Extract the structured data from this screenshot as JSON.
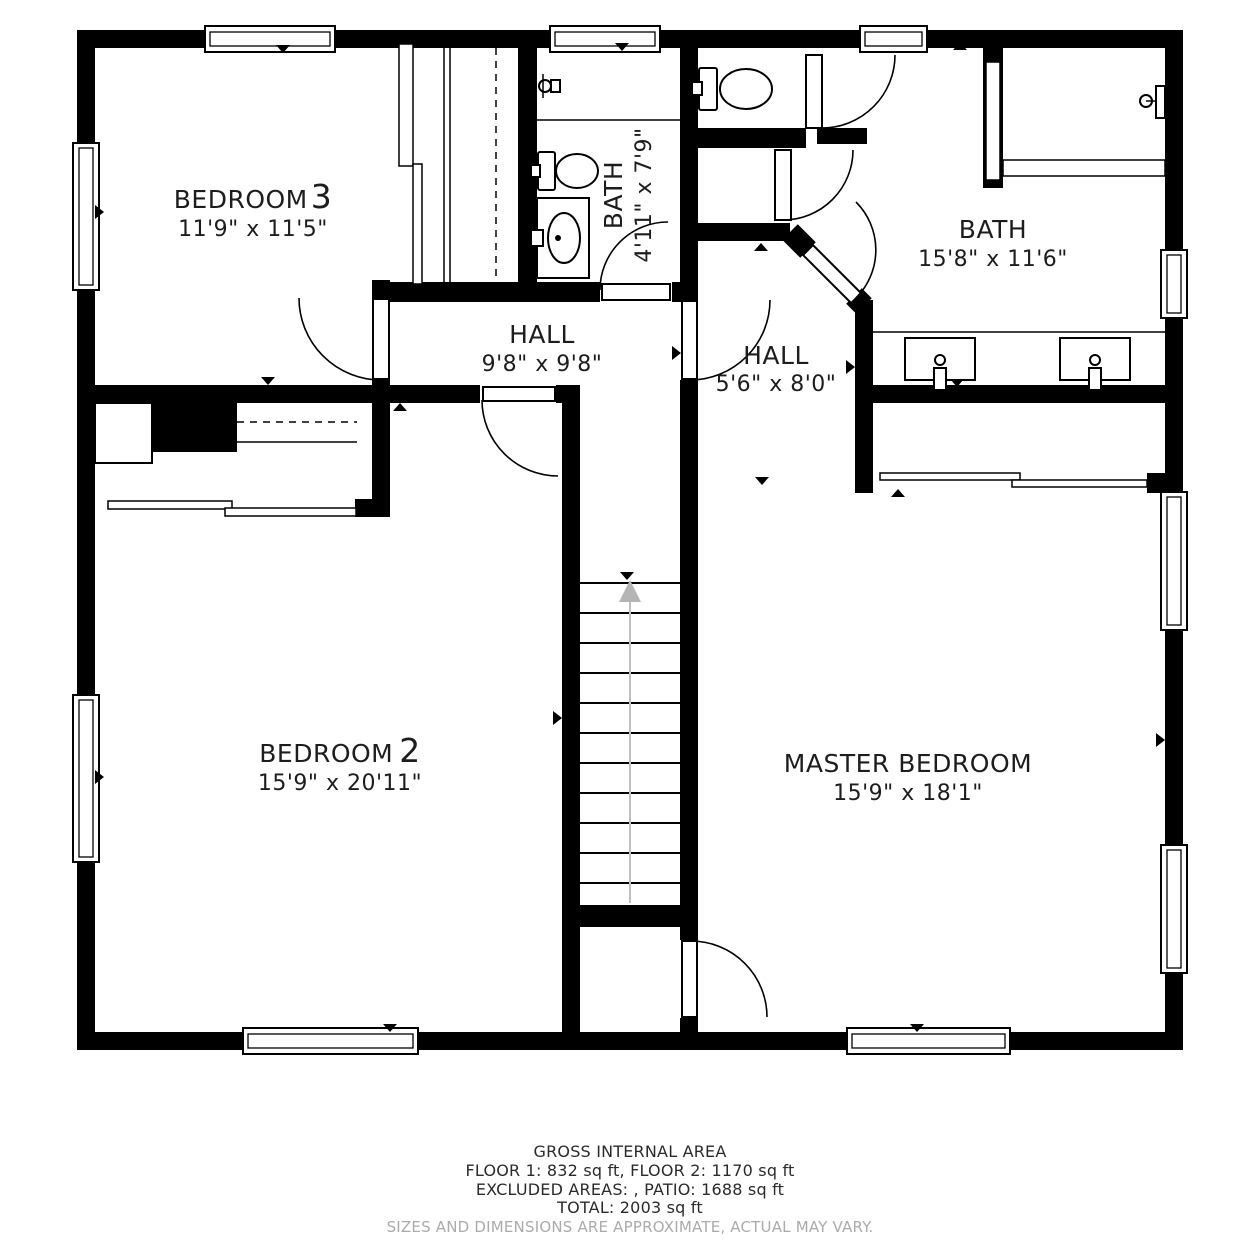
{
  "floor_plan": {
    "rooms": [
      {
        "id": "bedroom-3",
        "name": "BEDROOM",
        "number": "3",
        "dimensions": "11'9\" x 11'5\""
      },
      {
        "id": "bath-small",
        "name": "BATH",
        "number": "",
        "dimensions": "4'11\" x 7'9\""
      },
      {
        "id": "bath-main",
        "name": "BATH",
        "number": "",
        "dimensions": "15'8\" x 11'6\""
      },
      {
        "id": "hall-main",
        "name": "HALL",
        "number": "",
        "dimensions": "9'8\" x 9'8\""
      },
      {
        "id": "hall-small",
        "name": "HALL",
        "number": "",
        "dimensions": "5'6\" x 8'0\""
      },
      {
        "id": "bedroom-2",
        "name": "BEDROOM",
        "number": "2",
        "dimensions": "15'9\" x 20'11\""
      },
      {
        "id": "master-bedroom",
        "name": "MASTER BEDROOM",
        "number": "",
        "dimensions": "15'9\" x 18'1\""
      }
    ],
    "stairs": {
      "direction": "up"
    },
    "colors": {
      "wall": "#000000",
      "background": "#ffffff",
      "stairs_arrow": "#b5b5b5",
      "disclaimer_text": "#ababab"
    }
  },
  "footer": {
    "title": "GROSS INTERNAL AREA",
    "line1": "FLOOR 1: 832 sq ft, FLOOR 2: 1170 sq ft",
    "line2": "EXCLUDED AREAS: , PATIO: 1688 sq ft",
    "line3": "TOTAL: 2003 sq ft",
    "disclaimer": "SIZES AND DIMENSIONS ARE APPROXIMATE, ACTUAL MAY VARY."
  }
}
